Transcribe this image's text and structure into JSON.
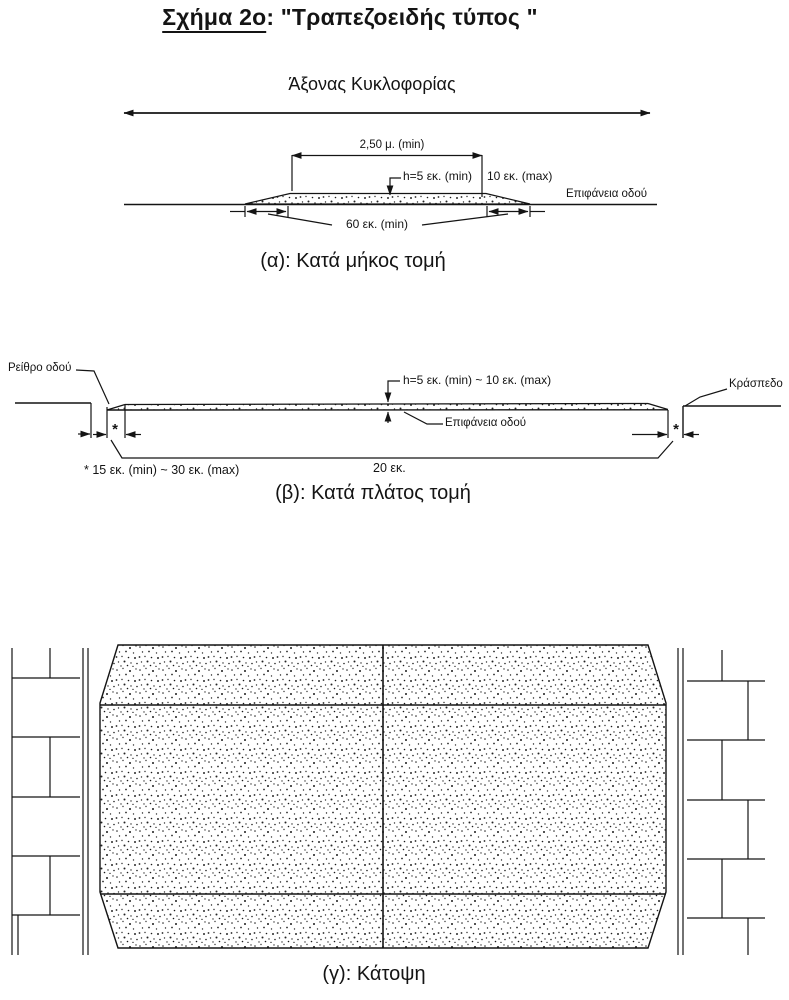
{
  "title": {
    "figure": "Σχήμα 2ο",
    "rest": ": \"Τραπεζοειδής τύπος \""
  },
  "section_a": {
    "axis_label": "Άξονας Κυκλοφορίας",
    "dim_top_width": "2,50 μ. (min)",
    "dim_height_min": "h=5 εκ. (min)",
    "dim_height_max": "10 εκ. (max)",
    "road_surface_label": "Επιφάνεια οδού",
    "dim_ramp_length": "60 εκ. (min)",
    "caption": "(α): Κατά μήκος τομή"
  },
  "section_b": {
    "gutter_label": "Ρείθρο οδού",
    "curb_label": "Κράσπεδο",
    "dim_height": "h=5 εκ. (min) ~ 10 εκ. (max)",
    "road_surface_label": "Επιφάνεια οδού",
    "star": "*",
    "footnote": "* 15 εκ. (min) ~ 30 εκ. (max)",
    "dim_slab_thickness": "20 εκ.",
    "caption": "(β): Κατά πλάτος τομή"
  },
  "section_c": {
    "caption": "(γ): Κάτοψη"
  },
  "colors": {
    "ink": "#141414",
    "paper": "#ffffff"
  }
}
